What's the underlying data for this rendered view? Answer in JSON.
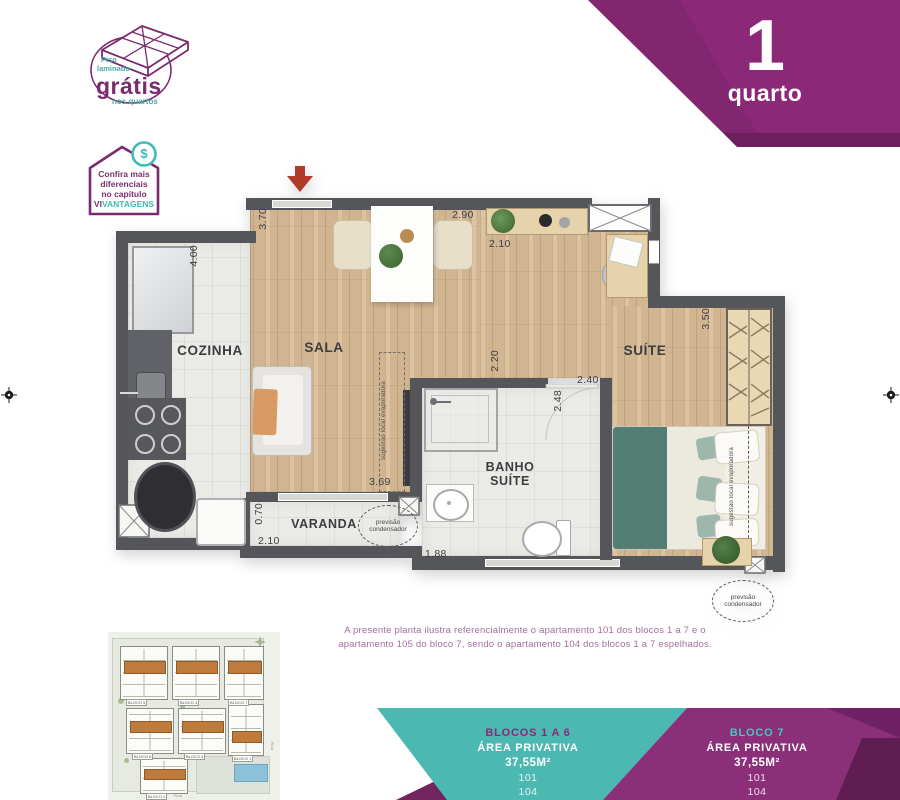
{
  "colors": {
    "purple": "#8b2978",
    "purple_dark": "#6d1e5c",
    "teal": "#4cb8b2",
    "wall": "#55565a",
    "wood": "#d9bc96",
    "unit_highlight": "#bf7b3c"
  },
  "stamp": {
    "top1": "Piso",
    "top2": "laminado",
    "main": "grátis",
    "bottom": "nos quartos"
  },
  "advantages_badge": {
    "line1": "Confira mais",
    "line2": "diferenciais",
    "line3": "no capítulo",
    "brand_prefix": "VI",
    "brand_suffix": "VANTAGENS",
    "dollar": "$"
  },
  "ribbon": {
    "number": "1",
    "label": "quarto"
  },
  "plan": {
    "rooms": {
      "cozinha": "COZINHA",
      "sala": "SALA",
      "suite": "SUÍTE",
      "banho_line1": "BANHO",
      "banho_line2": "SUÍTE",
      "varanda": "VARANDA"
    },
    "dims": {
      "cozinha_h": "4.00",
      "sala_h": "3.70",
      "sala_w": "2.90",
      "hall_w": "2.10",
      "suite_h": "3.50",
      "banho_door": "2.20",
      "banho_w": "2.40",
      "banho_h": "2.48",
      "sala_bottom": "3.69",
      "varanda_h": "0.70",
      "varanda_w": "2.10",
      "banho_bottom": "1.88"
    },
    "annotations": {
      "previsao_line1": "previsão",
      "previsao_line2": "condensador",
      "sugestao_line1": "sugestão local",
      "sugestao_line2": "evaporadora"
    }
  },
  "note": {
    "line1": "A presente planta ilustra referencialmente o apartamento 101 dos blocos 1 a 7 e o",
    "line2": "apartamento 105 do bloco 7, sendo o apartamento 104 dos blocos 1 a 7 espelhados."
  },
  "footer": {
    "left": {
      "title": "BLOCOS 1 A 6",
      "area_label": "ÁREA PRIVATIVA",
      "area_value": "37,55M²",
      "unit1": "101",
      "unit2": "104"
    },
    "right": {
      "title": "BLOCO 7",
      "area_label": "ÁREA PRIVATIVA",
      "area_value": "37,55M²",
      "unit1": "101",
      "unit2": "104"
    }
  },
  "siteplan": {
    "blocks": [
      {
        "label": "BLOCO 5"
      },
      {
        "label": "BLOCO 4"
      },
      {
        "label": "BLOCO 7"
      },
      {
        "label": "BLOCO 6"
      },
      {
        "label": "BLOCO 3"
      },
      {
        "label": "BLOCO 2"
      },
      {
        "label": "BLOCO 1"
      }
    ],
    "streets": {
      "bottom": "Rua",
      "right": "Rua"
    }
  }
}
